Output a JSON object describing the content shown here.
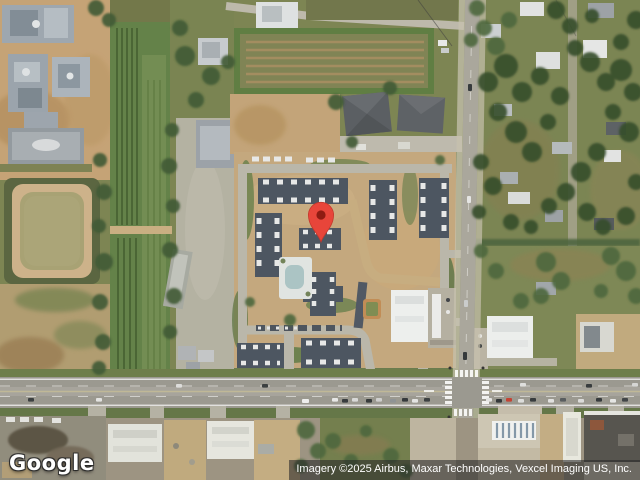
{
  "map": {
    "view": "satellite",
    "marker": {
      "color": "#E8453A",
      "dot_color": "#8E1B12"
    }
  },
  "branding": {
    "logo": "Google"
  },
  "footer": {
    "attribution": "Imagery ©2025 Airbus, Maxar Technologies, Vexcel Imaging US, Inc."
  }
}
